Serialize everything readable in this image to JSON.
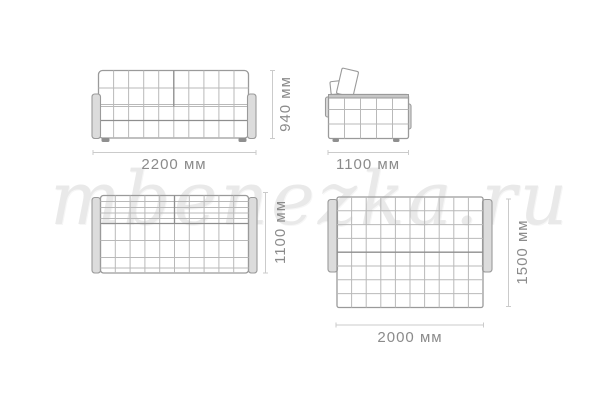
{
  "watermark": {
    "text": "mbenezka.ru"
  },
  "views": {
    "front": {
      "name": "sofa front view",
      "width_label": "2200 мм",
      "height_label": "940 мм"
    },
    "side": {
      "name": "sofa side view",
      "width_label": "1100 мм"
    },
    "top_folded": {
      "name": "sofa top view folded",
      "depth_label": "1100 мм"
    },
    "top_unfolded": {
      "name": "sofa top view unfolded bed",
      "width_label": "2000 мм",
      "depth_label": "1500 мм"
    }
  },
  "colors": {
    "background": "#ffffff",
    "outline": "#9a9a9a",
    "grid": "#b9b9b9",
    "grid_dark": "#8e8e8e",
    "armrest_fill": "#dcdcdc",
    "leg": "#8f8f8f",
    "dim_line": "#cbcbcb",
    "dim_text": "#8b8b8b",
    "watermark": "#e9e9e9"
  }
}
